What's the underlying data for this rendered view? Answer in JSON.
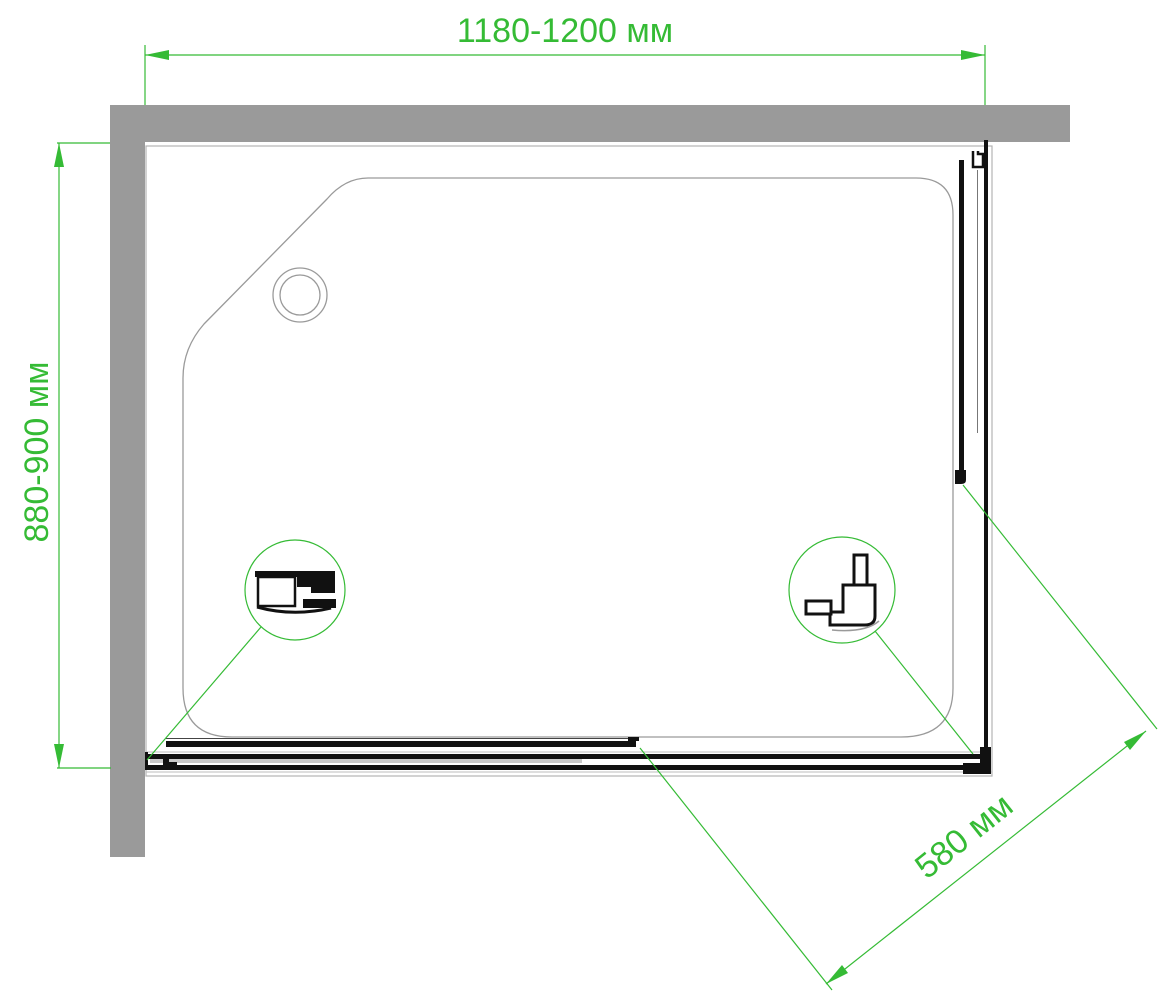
{
  "drawing": {
    "type": "shower-enclosure-top-view-technical-drawing",
    "labels": {
      "width": "1180-1200 мм",
      "depth": "880-900 мм",
      "entry": "580 мм"
    }
  },
  "colors": {
    "dimension": "#35bb35",
    "wall": "#9a9a9a",
    "outline": "#b3b3b3",
    "tray": "#9a9a9a",
    "profile": "#111111",
    "background": "#ffffff"
  }
}
